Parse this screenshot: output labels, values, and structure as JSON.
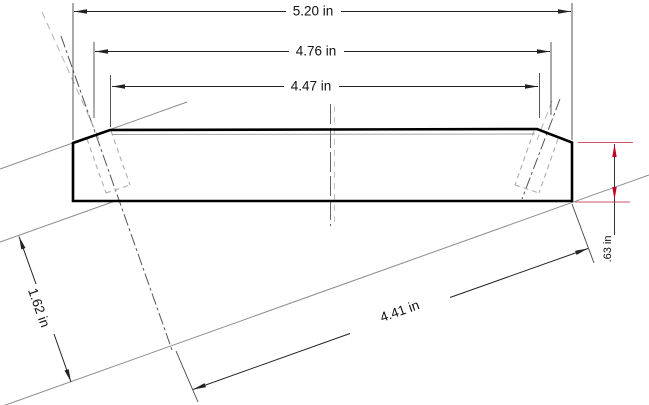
{
  "drawing": {
    "type": "technical-drawing",
    "dimensions": {
      "overall_width": "5.20 in",
      "bevel_width": "4.76 in",
      "flat_width": "4.47 in",
      "perpendicular_offset": "1.62 in",
      "tilted_length": "4.41 in",
      "edge_thickness": ".63 in"
    },
    "colors": {
      "outline": "#000000",
      "dimension_lines": "#222222",
      "construction_lines": "#8c8c8c",
      "hidden_lines": "#b3b3b3",
      "centerlines": "#555555",
      "accent_red": "#c40022",
      "background": "#ffffff"
    }
  }
}
